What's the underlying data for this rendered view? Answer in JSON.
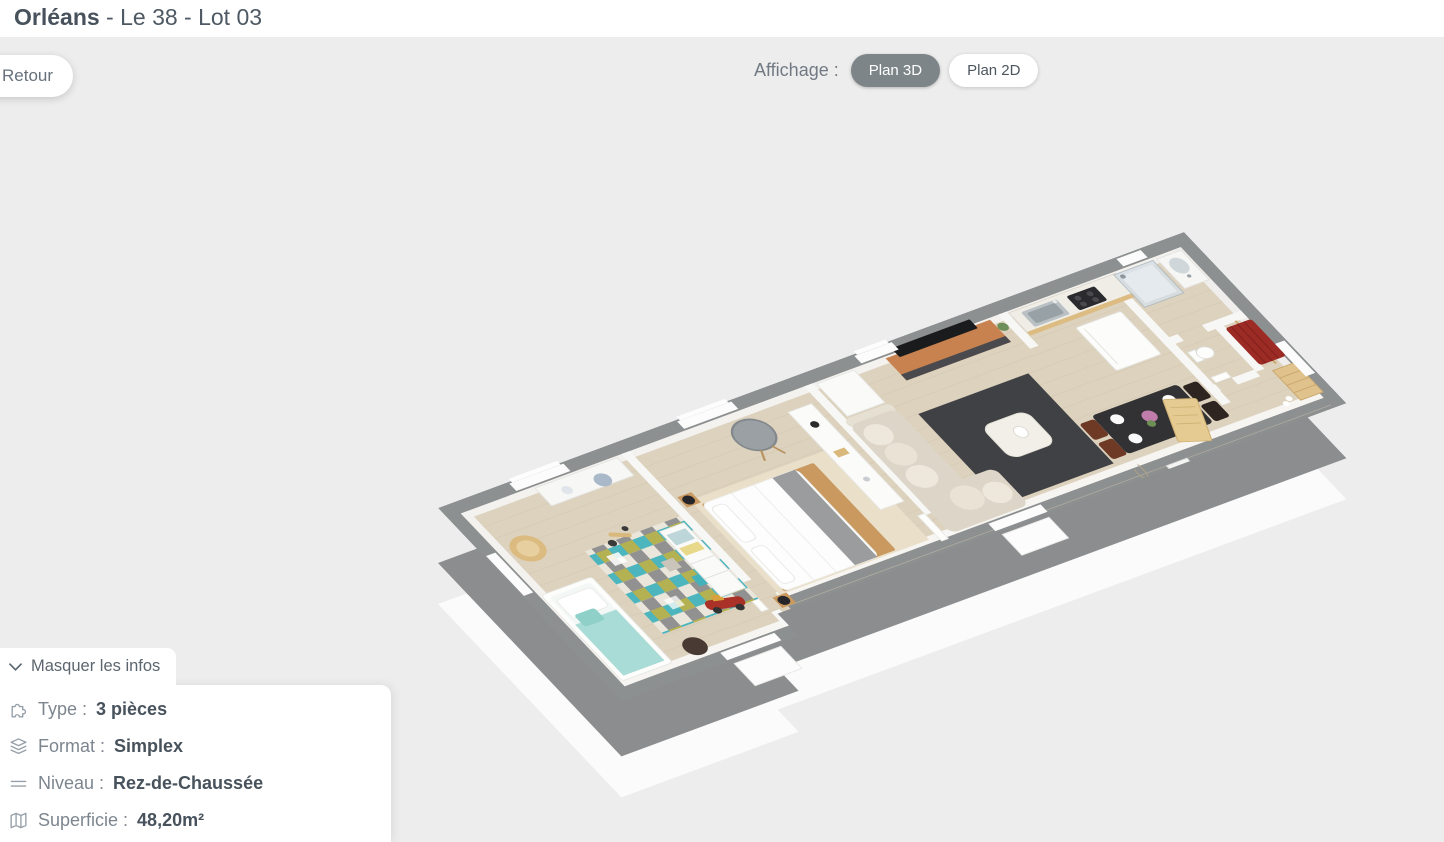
{
  "header": {
    "title_bold": "Orléans",
    "title_rest": " - Le 38 - Lot 03"
  },
  "toolbar": {
    "back_label": "Retour",
    "display_label": "Affichage :",
    "plan_3d_label": "Plan 3D",
    "plan_2d_label": "Plan 2D",
    "active_view": "Plan 3D"
  },
  "info_panel": {
    "toggle_label": "Masquer les infos",
    "rows": [
      {
        "icon": "puzzle-icon",
        "label": "Type :",
        "value": "3 pièces"
      },
      {
        "icon": "layers-icon",
        "label": "Format :",
        "value": "Simplex"
      },
      {
        "icon": "level-icon",
        "label": "Niveau :",
        "value": "Rez-de-Chaussée"
      },
      {
        "icon": "map-icon",
        "label": "Superficie :",
        "value": "48,20m²"
      }
    ]
  },
  "floor_plan": {
    "view": "3d-isometric-apartment",
    "rooms_visible": [
      "kids-bedroom",
      "master-bedroom",
      "living-dining-room",
      "kitchen",
      "bathroom",
      "wc",
      "entry-closet"
    ],
    "palette": {
      "page_background": "#ededed",
      "header_background": "#ffffff",
      "title_color": "#47525c",
      "active_pill_background": "#7d8589",
      "pill_text": "#4d575f",
      "wall_gray": "#8d9091",
      "floor_wood": "#ddd2be",
      "slab_white": "#fbfbfb",
      "rug_teal": "#45b2bb",
      "rug_olive": "#b1ae4b",
      "living_rug_dark": "#404144",
      "tv_unit_wood": "#c8824f",
      "closet_clothes_red": "#9c2b25"
    }
  }
}
